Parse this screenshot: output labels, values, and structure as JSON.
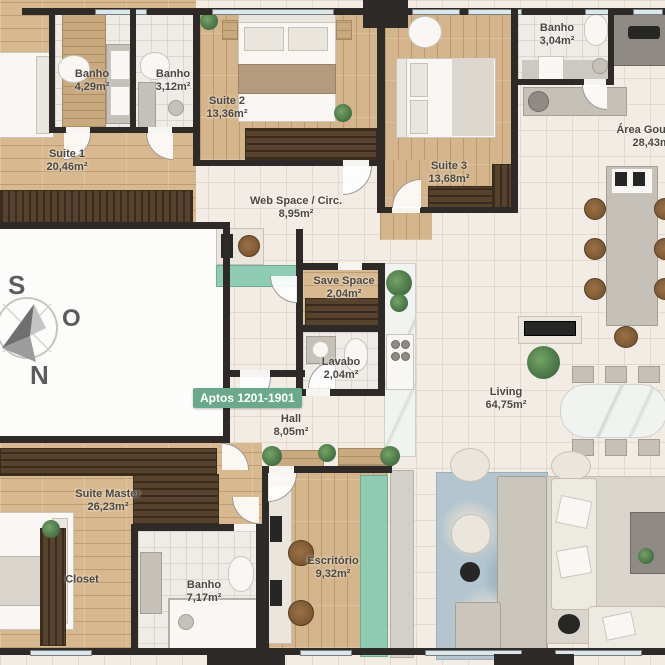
{
  "page": {
    "type": "apartment-floor-plan",
    "language": "pt-BR"
  },
  "badge": {
    "label": "Aptos 1201-1901"
  },
  "compass": {
    "south": "S",
    "west": "O",
    "north": "N"
  },
  "rooms": {
    "banho_suite1": {
      "name": "Banho",
      "area": "4,29m²"
    },
    "banho_suite2": {
      "name": "Banho",
      "area": "3,12m²"
    },
    "suite1": {
      "name": "Suite 1",
      "area": "20,46m²"
    },
    "suite2": {
      "name": "Suite 2",
      "area": "13,36m²"
    },
    "suite3": {
      "name": "Suite 3",
      "area": "13,68m²"
    },
    "banho_suite3": {
      "name": "Banho",
      "area": "3,04m²"
    },
    "area_gourmet": {
      "name": "Área Gourmet",
      "area": "28,43m²"
    },
    "web_space": {
      "name": "Web Space / Circ.",
      "area": "8,95m²"
    },
    "save_space": {
      "name": "Save Space",
      "area": "2,04m²"
    },
    "lavabo": {
      "name": "Lavabo",
      "area": "2,04m²"
    },
    "hall": {
      "name": "Hall",
      "area": "8,05m²"
    },
    "living": {
      "name": "Living",
      "area": "64,75m²"
    },
    "suite_master": {
      "name": "Suite Master",
      "area": "26,23m²"
    },
    "closet": {
      "name": "Closet",
      "area": ""
    },
    "banho_master": {
      "name": "Banho",
      "area": "7,17m²"
    },
    "escritorio": {
      "name": "Escritório",
      "area": "9,32m²"
    }
  },
  "colors": {
    "wall": "#2d2a27",
    "badge_green": "#6ba98c",
    "teal_accent": "#8fccb4",
    "wood_floor": "#d8b98f",
    "tile_floor": "#f3ece5",
    "wardrobe_brown": "#57422d"
  }
}
